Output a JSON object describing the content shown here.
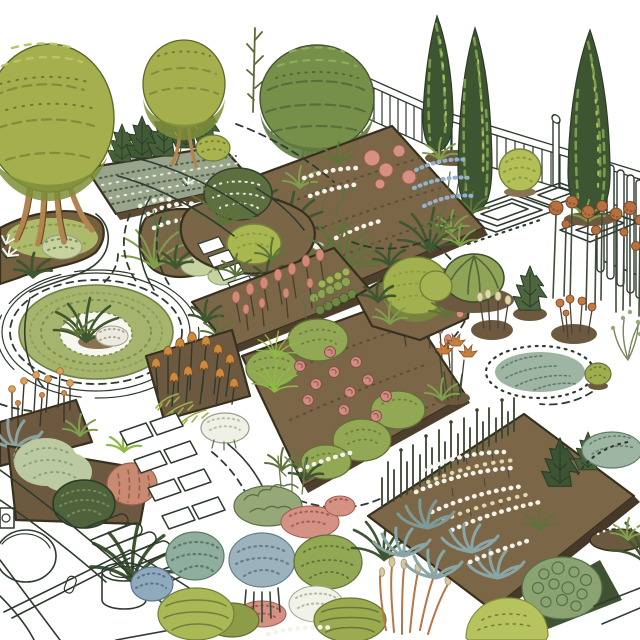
{
  "scene": {
    "type": "illustration",
    "subject": "Hand-drawn isometric garden plan with clipped trees, cypresses, flower beds, ring lawn, stepping stones and outline paths",
    "background": "#ffffff"
  },
  "palette": {
    "ink": "#2e3b2f",
    "canopy_olive": "#a5af4d",
    "canopy_olive_shade": "#7e8e3a",
    "canopy_olive_light": "#bac464",
    "topiary_green": "#76904a",
    "topiary_shade": "#5e7a40",
    "cypress_green": "#3e5531",
    "cypress_highlight": "#7d9a4f",
    "trunk_brown": "#b08550",
    "soil_brown": "#7b6647",
    "soil_dark": "#6d5940",
    "soil_edge": "#38301f",
    "lawn_green": "#a6b56d",
    "grass_dark": "#5d7438",
    "grass_mid": "#7fa04b",
    "grass_bright": "#8fbb45",
    "mound_green": "#a8b750",
    "mound_speckled": "#93a854",
    "ball_shrub_green": "#a2b14e",
    "bush_yellow_green": "#b4bf57",
    "pale_sage": "#bccaa2",
    "pale_mint": "#c6d2a0",
    "dark_shrub_green": "#4f623b",
    "conifer_green": "#46613a",
    "pink_bloom": "#d59284",
    "salmon_bloom": "#d08a76",
    "rose_pink": "#cf8d83",
    "salmon_mound": "#c98a72",
    "orange_flower": "#cd8a3e",
    "rust_orange": "#b5713f",
    "rust_grass": "#b5764a",
    "tan_seed": "#d8c79b",
    "cream": "#e3d7ae",
    "blue_flower": "#96b1cc",
    "blue_shrub": "#8fa9bd",
    "blue_green": "#8aa5a5",
    "mottled_blue": "#9db3bc",
    "hydrangea_green": "#8fae9d",
    "white_flower": "#f1f2e8",
    "fence_white": "#ffffff"
  },
  "elements": [
    {
      "name": "large-round-tree",
      "label": "Large clipped round tree, top left"
    },
    {
      "name": "small-round-tree",
      "label": "Smaller round tree beside it"
    },
    {
      "name": "topiary-ball-tree",
      "label": "Big ball topiary tree, top centre"
    },
    {
      "name": "sapling-tree",
      "label": "Thin sapling behind topiary"
    },
    {
      "name": "cypress-group",
      "label": "Three columnar cypresses, top right"
    },
    {
      "name": "garden-fence",
      "label": "White rail fence along the back"
    },
    {
      "name": "gate-pickets",
      "label": "Tall white pickets, right edge"
    },
    {
      "name": "conifer-bed",
      "label": "Speckled bed with young spruces"
    },
    {
      "name": "tree-island-bed",
      "label": "Island bed at foot of big tree"
    },
    {
      "name": "mixed-flower-bed",
      "label": "Large bed with white, pink and blue flowers"
    },
    {
      "name": "round-bush",
      "label": "Pale green ball bush by fence"
    },
    {
      "name": "geometric-path-outlines",
      "label": "Nested outline paving pattern"
    },
    {
      "name": "allium-row",
      "label": "Row of rust-orange globe flowers"
    },
    {
      "name": "circular-lawn",
      "label": "Ring shaped lawn with planted centre"
    },
    {
      "name": "gypsophila-bed",
      "label": "Bed with airy white flowers and pale mounds"
    },
    {
      "name": "knoll-cluster",
      "label": "Island with dark dome, bright mound, ladder stones"
    },
    {
      "name": "salmon-spike-bed",
      "label": "Diagonal bed of salmon flower spikes"
    },
    {
      "name": "tulip-bed",
      "label": "Bed of orange cup flowers, ferns, white mound"
    },
    {
      "name": "orange-stem-patch",
      "label": "Orange seed-head stems, left edge"
    },
    {
      "name": "left-border-bed",
      "label": "Pale sage, dark knobby and salmon mounds"
    },
    {
      "name": "stepping-stones",
      "label": "Tilted white slab walkway"
    },
    {
      "name": "hairpin-stripes",
      "label": "Hair-pin striped paving marks"
    },
    {
      "name": "patio-line-drawing",
      "label": "Outline patio with table and planter"
    },
    {
      "name": "rose-bed",
      "label": "Central bed with roses and speckled mounds"
    },
    {
      "name": "ball-shrub-island",
      "label": "Island bed with one big ball shrub"
    },
    {
      "name": "leafy-dome-island",
      "label": "Veined leafy dome on soil circle"
    },
    {
      "name": "dwarf-conifer-island",
      "label": "Small conifer on soil circle"
    },
    {
      "name": "seed-stem-circle",
      "label": "Soil circle with cream seed stems"
    },
    {
      "name": "globe-flower-circle",
      "label": "Soil circle with orange globes"
    },
    {
      "name": "blue-grass-drift",
      "label": "Blue-green grass drift with dashed ring"
    },
    {
      "name": "dwarf-shrub-island",
      "label": "Tiny round shrub"
    },
    {
      "name": "daylily-clump",
      "label": "Orange daylily clump"
    },
    {
      "name": "twiggy-shrub",
      "label": "Twiggy sage shrub at right edge"
    },
    {
      "name": "mixed-border",
      "label": "Dense colourful lower border"
    },
    {
      "name": "prairie-bed",
      "label": "Diamond bed with daisies, agaves, reeds"
    },
    {
      "name": "conifer-pair",
      "label": "Two small dark conifers in diamond bed"
    },
    {
      "name": "grass-tussock",
      "label": "Grass tussock on soil, bottom right"
    },
    {
      "name": "shrub-mound-pair",
      "label": "Yellow-green and bubble-textured mounds"
    },
    {
      "name": "blue-grass-mound",
      "label": "Blue-green grass mound with dashed arc"
    },
    {
      "name": "path-dashes",
      "label": "Dashed and dotted path guide lines"
    }
  ]
}
